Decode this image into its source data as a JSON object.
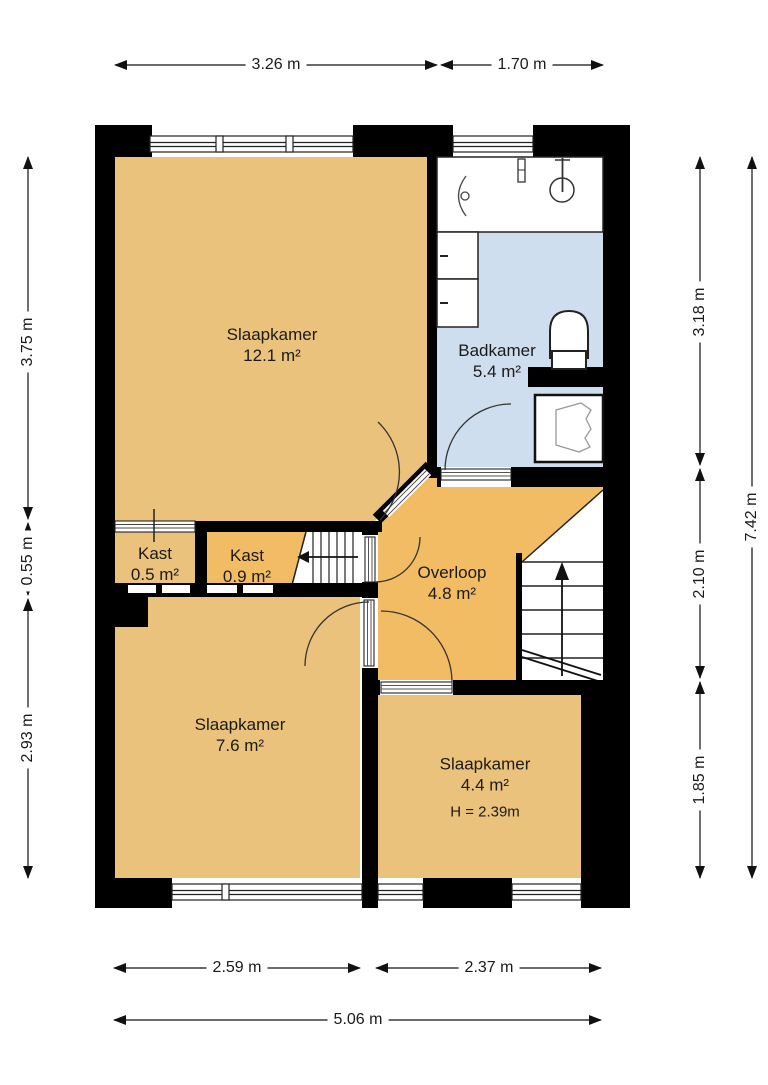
{
  "plan": {
    "title": "floorplan-first-floor",
    "rooms": [
      {
        "id": "slaapkamer-12",
        "name": "Slaapkamer",
        "area": "12.1 m²"
      },
      {
        "id": "badkamer",
        "name": "Badkamer",
        "area": "5.4 m²"
      },
      {
        "id": "kast-05",
        "name": "Kast",
        "area": "0.5 m²"
      },
      {
        "id": "kast-09",
        "name": "Kast",
        "area": "0.9 m²"
      },
      {
        "id": "overloop",
        "name": "Overloop",
        "area": "4.8 m²"
      },
      {
        "id": "slaapkamer-76",
        "name": "Slaapkamer",
        "area": "7.6 m²"
      },
      {
        "id": "slaapkamer-44",
        "name": "Slaapkamer",
        "area": "4.4 m²",
        "height_note": "H = 2.39m"
      }
    ],
    "dimensions": {
      "top": [
        "3.26 m",
        "1.70 m"
      ],
      "left": [
        "3.75 m",
        "0.55 m",
        "2.93 m"
      ],
      "right_inner": [
        "3.18 m",
        "2.10 m",
        "1.85 m"
      ],
      "right_outer": "7.42 m",
      "bottom": [
        "2.59 m",
        "2.37 m"
      ],
      "bottom_total": "5.06 m"
    },
    "colors": {
      "room_orange": "#EBC27B",
      "overloop_orange": "#F2BC64",
      "bathroom_blue": "#CFDEEE",
      "wall": "#000000"
    }
  }
}
